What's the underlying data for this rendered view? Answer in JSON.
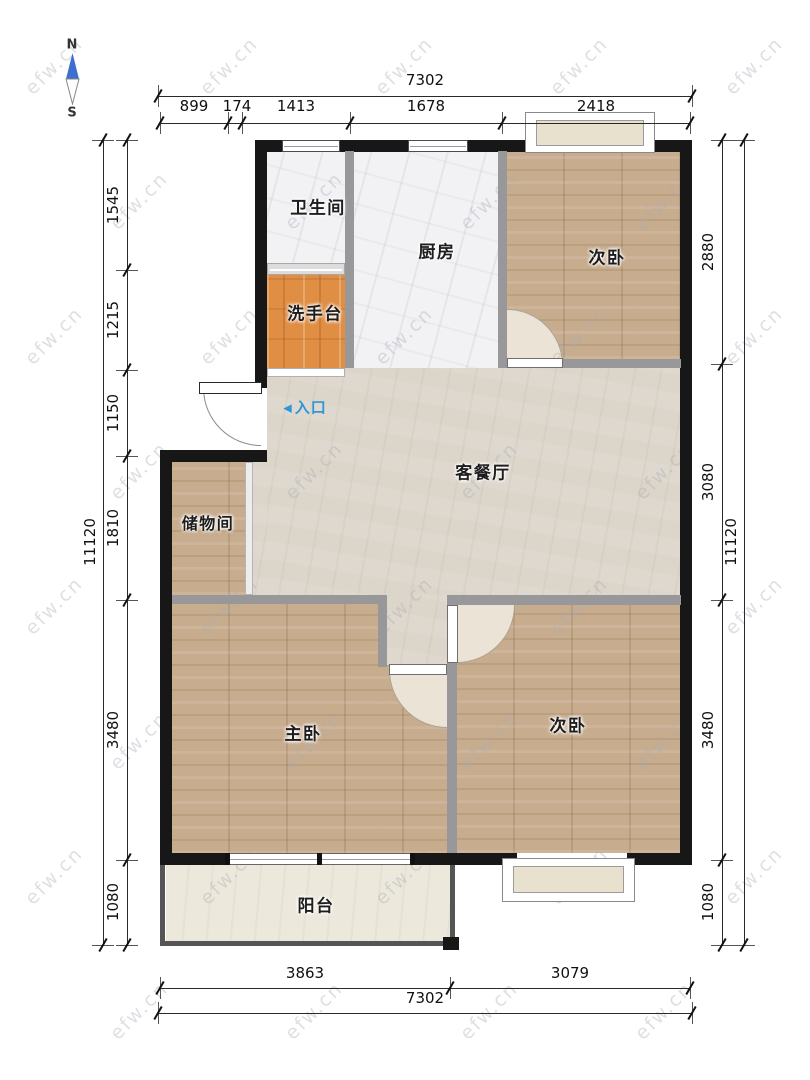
{
  "compass": {
    "north": "N",
    "south": "S"
  },
  "watermark": {
    "text": "efw.cn"
  },
  "entrance": {
    "arrow": "◀",
    "label": "入口"
  },
  "rooms": {
    "bathroom": {
      "label": "卫生间"
    },
    "kitchen": {
      "label": "厨房"
    },
    "bedroom_top": {
      "label": "次卧"
    },
    "washstand": {
      "label": "洗手台"
    },
    "living_dining": {
      "label": "客餐厅"
    },
    "storage": {
      "label": "储物间"
    },
    "master": {
      "label": "主卧"
    },
    "bedroom_bottom": {
      "label": "次卧"
    },
    "balcony": {
      "label": "阳台"
    }
  },
  "dimensions": {
    "top": {
      "total": "7302",
      "segments": [
        "899",
        "174",
        "1413",
        "1678",
        "2418"
      ]
    },
    "bottom": {
      "total": "7302",
      "segments": [
        "3863",
        "3079"
      ]
    },
    "left": {
      "total": "11120",
      "segments": [
        "1545",
        "1215",
        "1150",
        "1810",
        "3480",
        "1080"
      ]
    },
    "right": {
      "total": "11120",
      "segments": [
        "2880",
        "3080",
        "3480",
        "1080"
      ]
    }
  },
  "colors": {
    "outer_wall": "#171717",
    "inner_wall": "#98989a",
    "wood_floor": "#c7ac8e",
    "tile_floor": "#f2f2f4",
    "living_floor": "#dcd5ca",
    "washstand_floor": "#e08e44",
    "balcony_floor": "#ece8dc",
    "entrance_blue": "#2e97d8",
    "compass_blue": "#3e6fd0"
  }
}
